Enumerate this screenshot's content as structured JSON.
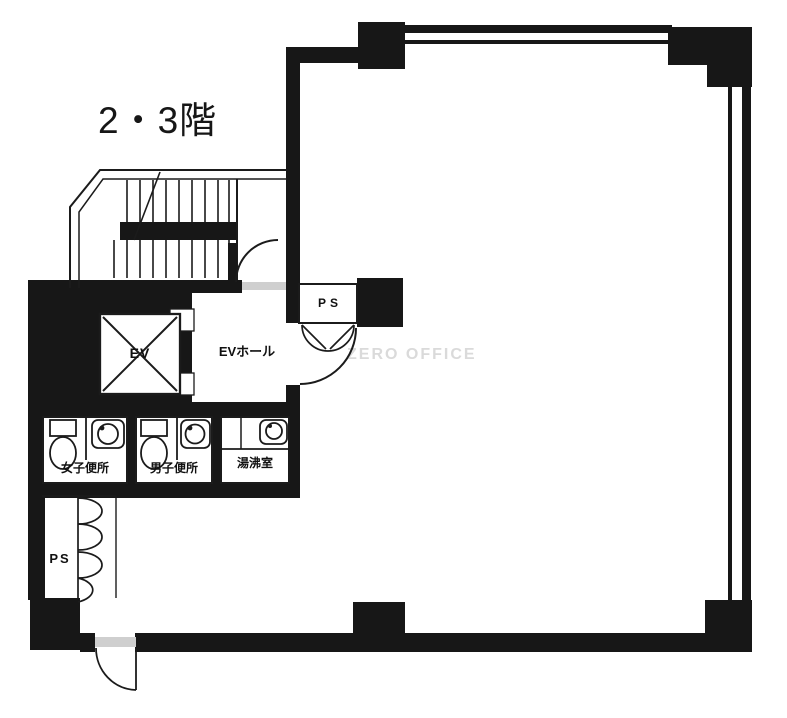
{
  "title": "2・3階",
  "watermark": "ZERO OFFICE",
  "labels": {
    "elevator": "EV",
    "elevator_hall": "EVホール",
    "pipe_shaft_top": "PS",
    "pipe_shaft_bottom": "PS",
    "womens_toilet": "女子便所",
    "mens_toilet": "男子便所",
    "kitchenette": "湯沸室"
  },
  "colors": {
    "wall": "#171717",
    "line": "#1b1b1b",
    "background": "#ffffff",
    "watermark": "#dadada",
    "threshold_gray": "#cfcfcf"
  }
}
